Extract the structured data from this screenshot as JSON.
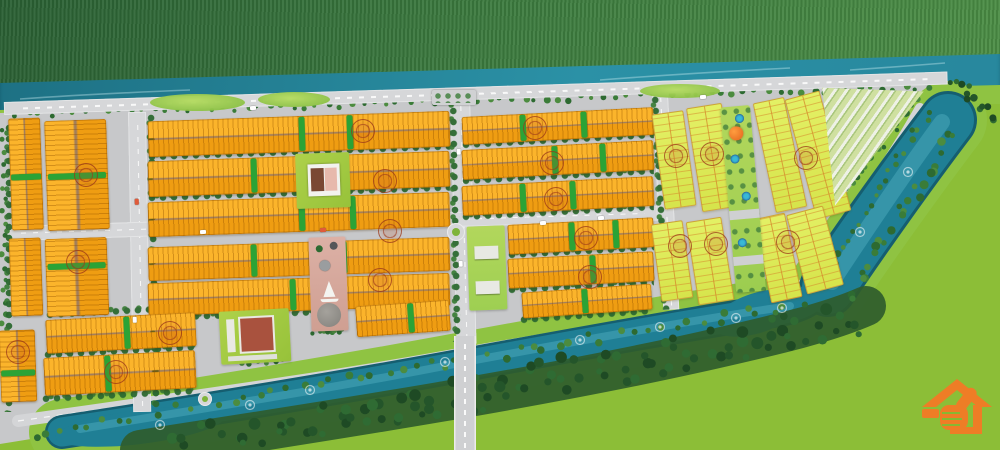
{
  "colors": {
    "field": "#8cbe37",
    "bank": "#8fc342",
    "ground": "#c7c8ca",
    "road": "#d6d7d9",
    "hedge": "#2ba336",
    "tree": "#2d6a31",
    "tree2": "#3d7f39",
    "water": "#1f7f95",
    "water_dark": "#155e70",
    "water_light": "#49a7ba",
    "forest": "#2f5c2c",
    "stampc": "rgba(155,55,25,0.75)",
    "logo": "#ee7d26"
  },
  "logo": {
    "icon": "house-thumbs-up-logo",
    "color": "#ee7d26",
    "position": "bottom-right"
  },
  "scene": {
    "orange_blocks": [
      [
        10,
        118,
        32,
        112,
        -2,
        "v",
        [
          50
        ]
      ],
      [
        46,
        120,
        62,
        110,
        -2,
        "v",
        [
          48
        ]
      ],
      [
        10,
        238,
        32,
        78,
        -2,
        "v",
        []
      ],
      [
        46,
        238,
        62,
        78,
        -2,
        "v",
        [
          32
        ]
      ],
      [
        0,
        330,
        36,
        72,
        -2,
        "v",
        [
          55
        ]
      ],
      [
        148,
        116,
        302,
        36,
        -2,
        "h",
        [
          50,
          66
        ]
      ],
      [
        148,
        156,
        302,
        36,
        -2,
        "h",
        [
          34,
          50
        ]
      ],
      [
        148,
        197,
        302,
        35,
        -2,
        "h",
        [
          50,
          67
        ]
      ],
      [
        148,
        242,
        302,
        34,
        -2,
        "h",
        [
          34,
          64
        ]
      ],
      [
        148,
        278,
        302,
        33,
        -2,
        "h",
        [
          47
        ]
      ],
      [
        46,
        316,
        150,
        34,
        -3,
        "h",
        [
          52
        ]
      ],
      [
        44,
        354,
        152,
        38,
        -3,
        "h",
        [
          40
        ]
      ],
      [
        356,
        303,
        94,
        31,
        -4,
        "h",
        [
          55
        ]
      ],
      [
        462,
        112,
        192,
        28,
        -3,
        "h",
        [
          30,
          62
        ]
      ],
      [
        462,
        145,
        192,
        30,
        -3,
        "h",
        [
          47,
          72
        ]
      ],
      [
        462,
        181,
        192,
        30,
        -3,
        "h",
        [
          30,
          56
        ]
      ],
      [
        508,
        221,
        146,
        30,
        -3,
        "h",
        [
          42,
          72
        ]
      ],
      [
        508,
        255,
        146,
        30,
        -3,
        "h",
        [
          56
        ]
      ],
      [
        522,
        288,
        130,
        26,
        -4,
        "h",
        [
          46
        ]
      ]
    ],
    "yellow_plots": [
      [
        658,
        112,
        32,
        96,
        -8
      ],
      [
        694,
        105,
        36,
        105,
        -9
      ],
      [
        764,
        99,
        32,
        112,
        -12
      ],
      [
        800,
        93,
        36,
        124,
        -15
      ],
      [
        656,
        222,
        32,
        78,
        -8
      ],
      [
        692,
        219,
        36,
        84,
        -9
      ],
      [
        762,
        215,
        32,
        86,
        -12
      ],
      [
        796,
        209,
        38,
        82,
        -15
      ]
    ],
    "roads": [
      [
        128,
        112,
        18,
        300,
        -1,
        "v"
      ],
      [
        450,
        94,
        20,
        250,
        -1.5,
        "v"
      ],
      [
        652,
        94,
        16,
        216,
        -3,
        "v"
      ],
      [
        8,
        226,
        650,
        15,
        -1.8,
        "h"
      ],
      [
        4,
        102,
        944,
        13,
        -1.85,
        "h"
      ]
    ],
    "treelines": [
      [
        148,
        152,
        302,
        -2,
        0
      ],
      [
        148,
        193,
        302,
        -2,
        0
      ],
      [
        148,
        313,
        200,
        -2,
        0
      ],
      [
        46,
        310,
        150,
        -3,
        0
      ],
      [
        44,
        350,
        152,
        -3,
        0
      ],
      [
        42,
        394,
        154,
        -3,
        0
      ],
      [
        462,
        140,
        192,
        -3,
        0
      ],
      [
        462,
        176,
        192,
        -3,
        0
      ],
      [
        462,
        212,
        192,
        -3,
        0
      ],
      [
        508,
        250,
        146,
        -3,
        0
      ],
      [
        508,
        285,
        146,
        -3,
        0
      ],
      [
        520,
        315,
        132,
        -4,
        0
      ],
      [
        146,
        114,
        298,
        -1,
        1
      ],
      [
        448,
        96,
        246,
        -1,
        1
      ],
      [
        650,
        96,
        214,
        -3,
        1
      ],
      [
        4,
        124,
        288,
        0,
        1
      ]
    ],
    "stamps": [
      [
        86,
        175
      ],
      [
        78,
        262
      ],
      [
        18,
        352
      ],
      [
        116,
        372
      ],
      [
        363,
        131
      ],
      [
        385,
        181
      ],
      [
        390,
        231
      ],
      [
        380,
        280
      ],
      [
        170,
        333
      ],
      [
        535,
        128
      ],
      [
        552,
        163
      ],
      [
        556,
        199
      ],
      [
        586,
        238
      ],
      [
        590,
        277
      ],
      [
        676,
        156
      ],
      [
        712,
        154
      ],
      [
        806,
        158
      ],
      [
        680,
        246
      ],
      [
        716,
        244
      ],
      [
        788,
        242
      ]
    ],
    "fountains": [
      [
        250,
        405
      ],
      [
        445,
        362
      ],
      [
        580,
        340
      ],
      [
        660,
        327
      ],
      [
        736,
        318
      ],
      [
        860,
        232
      ],
      [
        908,
        172
      ],
      [
        160,
        425
      ],
      [
        310,
        390
      ],
      [
        782,
        308
      ]
    ],
    "tree_rows": [
      [
        10,
        115,
        935,
        87,
        80,
        3,
        2,
        3.5,
        0
      ],
      [
        25,
        433,
        808,
        303,
        55,
        6,
        2.5,
        4,
        0
      ],
      [
        150,
        447,
        856,
        312,
        60,
        12,
        3.5,
        6,
        1
      ],
      [
        230,
        449,
        870,
        326,
        50,
        9,
        3,
        5,
        1
      ],
      [
        952,
        132,
        848,
        300,
        26,
        7,
        2.5,
        4.5,
        0
      ],
      [
        933,
        106,
        820,
        282,
        22,
        4,
        2,
        3.5,
        0
      ],
      [
        840,
        198,
        918,
        97,
        18,
        3,
        2,
        3.5,
        0
      ],
      [
        950,
        75,
        998,
        120,
        12,
        6,
        2.5,
        4,
        1
      ],
      [
        4,
        124,
        4,
        400,
        24,
        2.5,
        2,
        3,
        0
      ],
      [
        312,
        333,
        346,
        331,
        8,
        2,
        2,
        3,
        0
      ],
      [
        222,
        363,
        288,
        361,
        8,
        2,
        2,
        3,
        0
      ]
    ],
    "roundabouts": [
      [
        456,
        232,
        9
      ],
      [
        205,
        399,
        7
      ]
    ],
    "cars": [
      [
        200,
        230,
        -2,
        "#ffffff"
      ],
      [
        320,
        228,
        -2,
        "#e05a3a"
      ],
      [
        456,
        150,
        88,
        "#ffffff"
      ],
      [
        458,
        262,
        88,
        "#ffffff"
      ],
      [
        540,
        221,
        -2,
        "#ffffff"
      ],
      [
        134,
        200,
        88,
        "#e05a3a"
      ],
      [
        132,
        318,
        88,
        "#ffffff"
      ],
      [
        598,
        216,
        -2,
        "#ffffff"
      ],
      [
        250,
        106,
        -2,
        "#ffffff"
      ],
      [
        700,
        95,
        -2,
        "#ffffff"
      ]
    ],
    "amenity_pools": [
      8,
      48,
      86,
      132
    ],
    "amenity_plazas": [
      104,
      150
    ],
    "parkB_roofs": [
      20,
      55
    ]
  }
}
